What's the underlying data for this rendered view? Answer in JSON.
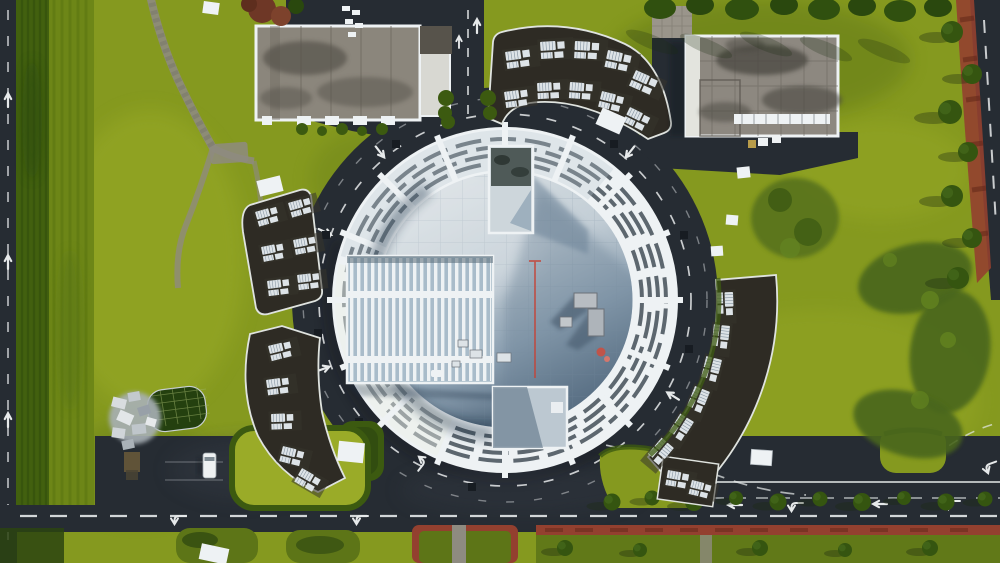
{
  "image": {
    "title": "Aerial drone view of a circular glass-roofed building campus",
    "type": "aerial-photograph",
    "visible_text": "none"
  },
  "palette": {
    "grass": "#85991f",
    "grassLight": "#9aab28",
    "grassDark": "#5d7517",
    "hedge": "#3c5a10",
    "hedgeDark": "#2c4410",
    "asphalt": "#262c33",
    "asphaltLight": "#343b44",
    "roadline": "#e6e9ea",
    "roofWhite": "#eef2f4",
    "ringSlat": "#39454e",
    "roofLight": "#dde3e6",
    "roofMid": "#8da1b2",
    "roofDark": "#4e6479",
    "grayRoof": "#8b867c",
    "grayRoofDark": "#57534b",
    "clusterRoof": "#2e2b24",
    "acUnit": "#dde3e7",
    "brick": "#93402f",
    "stonePath": "#8e8b80",
    "annexBase": "#a9bcca",
    "van": "#eef1f2",
    "redPipe": "#c2453a",
    "autumnTree": "#6e3726"
  },
  "scene": {
    "regions": [
      {
        "name": "central-circular-building",
        "feature": "white louvered ring with pale blue rooftop, two skylight boxes, rooftop equipment, red service pipe"
      },
      {
        "name": "ring-road",
        "feature": "dark asphalt loop with white dashed lane lines and drain covers"
      },
      {
        "name": "left-annex",
        "feature": "rectangular louvered roof section extending west"
      },
      {
        "name": "top-left-building",
        "feature": "rectangular gray flat roof with white parapet"
      },
      {
        "name": "top-right-building",
        "feature": "rectangular gray grid roof with white parapet"
      },
      {
        "name": "housing-cluster-top",
        "feature": "curved row of dark roofs with white HVAC units"
      },
      {
        "name": "housing-cluster-left-upper",
        "feature": "tilted block of dark roofs with HVAC units"
      },
      {
        "name": "housing-cluster-left-lower",
        "feature": "curved row of dark roofs with HVAC units"
      },
      {
        "name": "housing-cluster-right",
        "feature": "long curved arc of dark roofs with HVAC units"
      },
      {
        "name": "bottom-plaza-roads",
        "feature": "wide asphalt with arrows, grass islands, red-brick medians"
      },
      {
        "name": "left-road-and-hedges",
        "feature": "vertical road with hedge windbreak rows"
      },
      {
        "name": "right-edge-road",
        "feature": "diagonal road with red walkway strip and trees"
      },
      {
        "name": "lawns",
        "feature": "yellow-green lawns, crescent shrub patch, stone footpath"
      },
      {
        "name": "details",
        "feature": "white van, debris pile, netted pond, white tarps, benches"
      }
    ]
  }
}
